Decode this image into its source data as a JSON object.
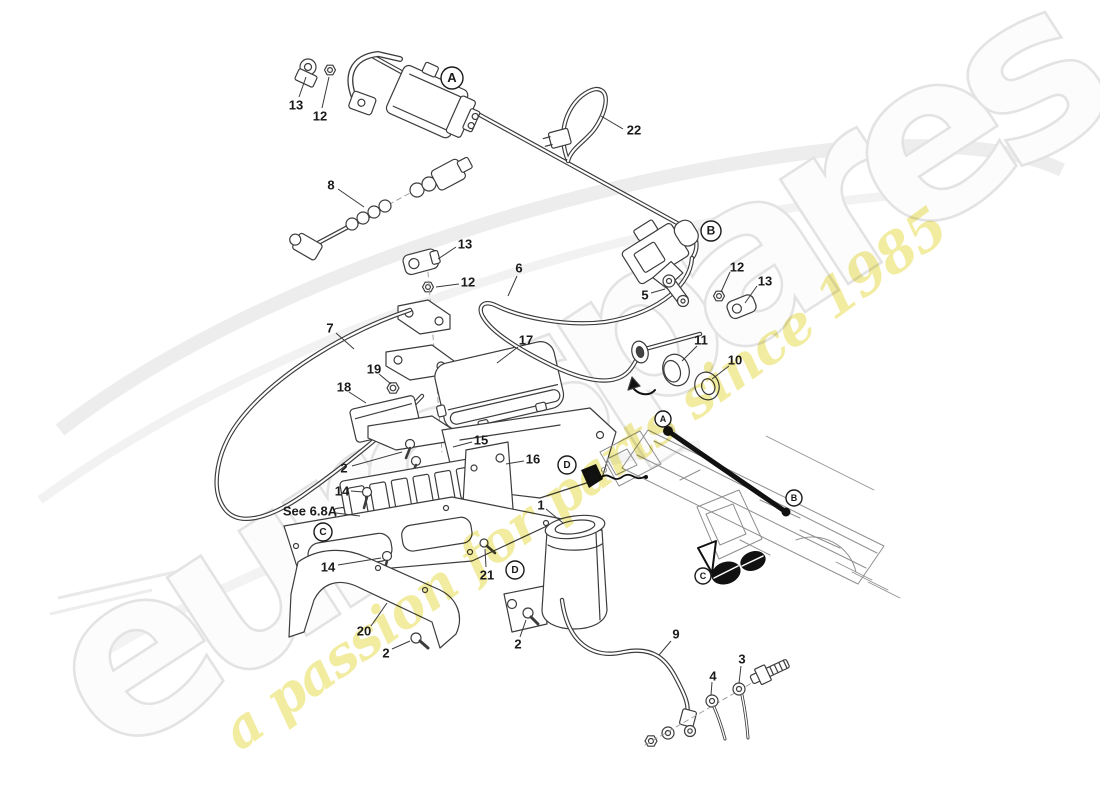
{
  "watermarks": {
    "primary": "eurospares",
    "secondary": "a passion for parts since 1985",
    "primary_fill": "#fcfcfc",
    "primary_stroke": "#e3e3e3",
    "secondary_fill": "#f0e88c"
  },
  "colors": {
    "label_text": "#1a1a1a",
    "leader_line": "#3a3a3a",
    "callout_stroke": "#1a1a1a",
    "line_art": "#3c3c3c"
  },
  "note": {
    "reference": "See 6.8A"
  },
  "labels": [
    {
      "text": "13",
      "tx": 296,
      "ty": 106,
      "l": [
        299,
        97,
        306,
        77
      ]
    },
    {
      "text": "12",
      "tx": 320,
      "ty": 117,
      "l": [
        322,
        108,
        329,
        77
      ]
    },
    {
      "text": "22",
      "tx": 634,
      "ty": 131,
      "l": [
        623,
        129,
        601,
        116
      ]
    },
    {
      "text": "8",
      "tx": 331,
      "ty": 186,
      "l": [
        338,
        189,
        364,
        207
      ]
    },
    {
      "text": "13",
      "tx": 465,
      "ty": 245,
      "l": [
        456,
        247,
        438,
        259
      ]
    },
    {
      "text": "6",
      "tx": 519,
      "ty": 269,
      "l": [
        517,
        276,
        508,
        296
      ]
    },
    {
      "text": "12",
      "tx": 468,
      "ty": 283,
      "l": [
        459,
        284,
        436,
        287
      ]
    },
    {
      "text": "12",
      "tx": 737,
      "ty": 268,
      "l": [
        730,
        272,
        721,
        292
      ]
    },
    {
      "text": "13",
      "tx": 765,
      "ty": 282,
      "l": [
        757,
        286,
        745,
        303
      ]
    },
    {
      "text": "5",
      "tx": 645,
      "ty": 296,
      "l": [
        651,
        293,
        665,
        289
      ]
    },
    {
      "text": "7",
      "tx": 330,
      "ty": 329,
      "l": [
        336,
        333,
        354,
        349
      ]
    },
    {
      "text": "17",
      "tx": 526,
      "ty": 341,
      "l": [
        518,
        347,
        497,
        363
      ]
    },
    {
      "text": "11",
      "tx": 701,
      "ty": 341,
      "l": [
        697,
        346,
        682,
        361
      ]
    },
    {
      "text": "10",
      "tx": 735,
      "ty": 361,
      "l": [
        729,
        366,
        712,
        379
      ]
    },
    {
      "text": "19",
      "tx": 374,
      "ty": 370,
      "l": [
        379,
        374,
        391,
        384
      ]
    },
    {
      "text": "18",
      "tx": 344,
      "ty": 388,
      "l": [
        349,
        392,
        366,
        403
      ]
    },
    {
      "text": "15",
      "tx": 481,
      "ty": 441,
      "l": [
        472,
        442,
        453,
        447
      ]
    },
    {
      "text": "16",
      "tx": 533,
      "ty": 460,
      "l": [
        524,
        461,
        506,
        464
      ]
    },
    {
      "text": "2",
      "tx": 344,
      "ty": 469,
      "l": [
        352,
        466,
        402,
        452
      ]
    },
    {
      "text": "14",
      "tx": 342,
      "ty": 492,
      "l": [
        351,
        491,
        363,
        492
      ]
    },
    {
      "text": "1",
      "tx": 541,
      "ty": 506,
      "l": [
        546,
        509,
        563,
        523
      ]
    },
    {
      "text": "See 6.8A",
      "tx": 310,
      "ty": 512,
      "l": [
        336,
        513,
        360,
        516
      ]
    },
    {
      "text": "14",
      "tx": 328,
      "ty": 568,
      "l": [
        338,
        565,
        381,
        558
      ]
    },
    {
      "text": "21",
      "tx": 487,
      "ty": 576,
      "l": [
        486,
        567,
        485,
        549
      ]
    },
    {
      "text": "20",
      "tx": 364,
      "ty": 632,
      "l": [
        371,
        626,
        387,
        603
      ]
    },
    {
      "text": "2",
      "tx": 386,
      "ty": 654,
      "l": [
        392,
        649,
        410,
        641
      ]
    },
    {
      "text": "2",
      "tx": 518,
      "ty": 645,
      "l": [
        520,
        637,
        526,
        620
      ]
    },
    {
      "text": "9",
      "tx": 676,
      "ty": 635,
      "l": [
        671,
        641,
        659,
        655
      ]
    },
    {
      "text": "3",
      "tx": 742,
      "ty": 660,
      "l": [
        741,
        666,
        739,
        683
      ]
    },
    {
      "text": "4",
      "tx": 713,
      "ty": 677,
      "l": [
        712,
        682,
        711,
        695
      ]
    }
  ],
  "callouts": [
    {
      "letter": "A",
      "x": 452,
      "y": 78,
      "r": 11
    },
    {
      "letter": "B",
      "x": 711,
      "y": 231,
      "r": 10
    },
    {
      "letter": "A",
      "x": 663,
      "y": 419,
      "r": 8
    },
    {
      "letter": "D",
      "x": 567,
      "y": 465,
      "r": 9
    },
    {
      "letter": "B",
      "x": 794,
      "y": 498,
      "r": 8
    },
    {
      "letter": "C",
      "x": 323,
      "y": 532,
      "r": 9
    },
    {
      "letter": "D",
      "x": 515,
      "y": 570,
      "r": 9
    },
    {
      "letter": "C",
      "x": 703,
      "y": 576,
      "r": 8
    }
  ]
}
